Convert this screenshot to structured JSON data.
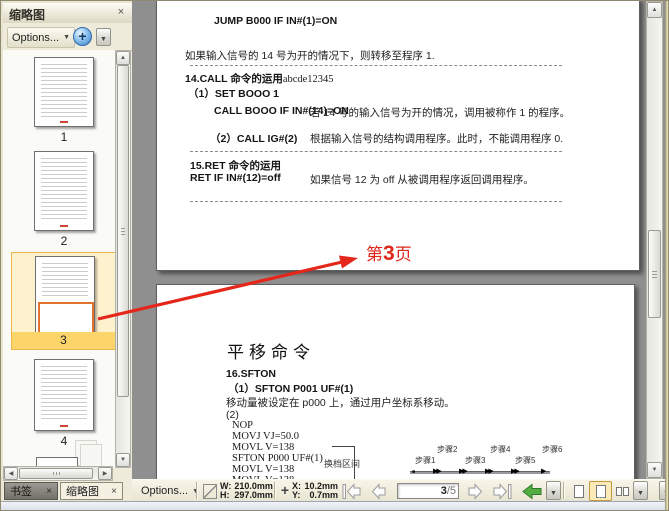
{
  "colors": {
    "annotation_red": "#e0251a",
    "selection_gold": "#edb64e",
    "selected_label_bg": "#fbd46a",
    "viewbox_orange": "#e2722c",
    "panel_bg": "#eeebdb",
    "doc_bg": "#8f8f8f",
    "toolbar_bg": "#efecdc"
  },
  "icons": {
    "close": "×",
    "chevron_down": "▼",
    "scroll_up": "▲",
    "scroll_down": "▼",
    "scroll_left": "◀",
    "scroll_right": "▶",
    "zoom_in_plus": "+",
    "crosshair": "+",
    "step_start_marker": "■",
    "step_pair_marker": "▶▶",
    "step_end_marker": "▶"
  },
  "left_panel": {
    "title": "缩略图",
    "toolbar": {
      "options_label": "Options..."
    },
    "thumbnails": [
      {
        "number": "1"
      },
      {
        "number": "2"
      },
      {
        "number": "3",
        "selected": true
      },
      {
        "number": "4"
      }
    ],
    "tabs": [
      {
        "label": "书签",
        "close": "×",
        "active": false
      },
      {
        "label": "缩略图",
        "close": "×",
        "active": true
      }
    ]
  },
  "annotation": {
    "page_label_pre": "第",
    "page_label_num": "3",
    "page_label_post": "页"
  },
  "page_top": {
    "jump_code": "JUMP B000 IF IN#(1)=ON",
    "jump_desc": "如果输入信号的 14 号为开的情况下，则转移至程序 1.",
    "call_title": "14.CALL 命令的运用",
    "call_title_suffix": "abcde12345",
    "call_line1": "（1）SET BOOO 1",
    "call_code2": "CALL BOOO IF IN#(14)=ON",
    "call_desc2": "若 14 号的输入信号为开的情况，调用被称作 1 的程序。",
    "call_code3": "（2）CALL IG#(2)",
    "call_desc3": "根据输入信号的结构调用程序。此时，不能调用程序 0.",
    "ret_title": "15.RET 命令的运用",
    "ret_code": "RET IF IN#(12)=off",
    "ret_desc": "如果信号 12 为 off 从被调用程序返回调用程序。"
  },
  "page_bottom": {
    "heading": "平移命令",
    "sec_title": "16.SFTON",
    "line1": "（1）SFTON P001 UF#(1)",
    "line2": "移动量被设定在 p000 上，通过用户坐标系移动。",
    "line3": "(2)",
    "code": [
      "NOP",
      "MOVJ VJ=50.0",
      "MOVL V=138",
      "SFTON P000 UF#(1)",
      "MOVL V=138",
      "MOVL V=138"
    ],
    "bracket_label": "换档区间",
    "steps": [
      "步骤1",
      "步骤2",
      "步骤3",
      "步骤4",
      "步骤5",
      "步骤6"
    ]
  },
  "bottom_toolbar": {
    "options_label": "Options...",
    "width_label": "W:",
    "width_value": "210.0mm",
    "height_label": "H:",
    "height_value": "297.0mm",
    "x_label": "X:",
    "x_value": "10.2mm",
    "y_label": "Y:",
    "y_value": "0.7mm",
    "page_current": "3",
    "page_total": "/5"
  }
}
